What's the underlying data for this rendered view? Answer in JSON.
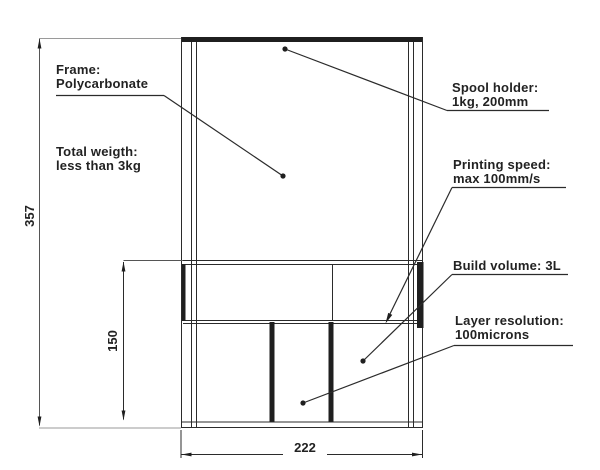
{
  "drawing": {
    "type": "technical-drawing-3d-printer-front-view",
    "background_color": "#ffffff",
    "line_color": "#2b2b2b",
    "extension_line_color": "#9a9a9a",
    "annotations": {
      "frame": {
        "line1": "Frame:",
        "line2": "Polycarbonate"
      },
      "total_weight": {
        "line1": "Total weigth:",
        "line2": "less than 3kg"
      },
      "spool_holder": {
        "line1": "Spool holder:",
        "line2": "1kg, 200mm"
      },
      "printing_speed": {
        "line1": "Printing speed:",
        "line2": "max 100mm/s"
      },
      "build_volume": {
        "line1": "Build volume: 3L"
      },
      "layer_resolution": {
        "line1": "Layer resolution:",
        "line2": "100microns"
      }
    },
    "dimensions": {
      "overall_height": "357",
      "lower_section_height": "150",
      "overall_width": "222"
    }
  }
}
